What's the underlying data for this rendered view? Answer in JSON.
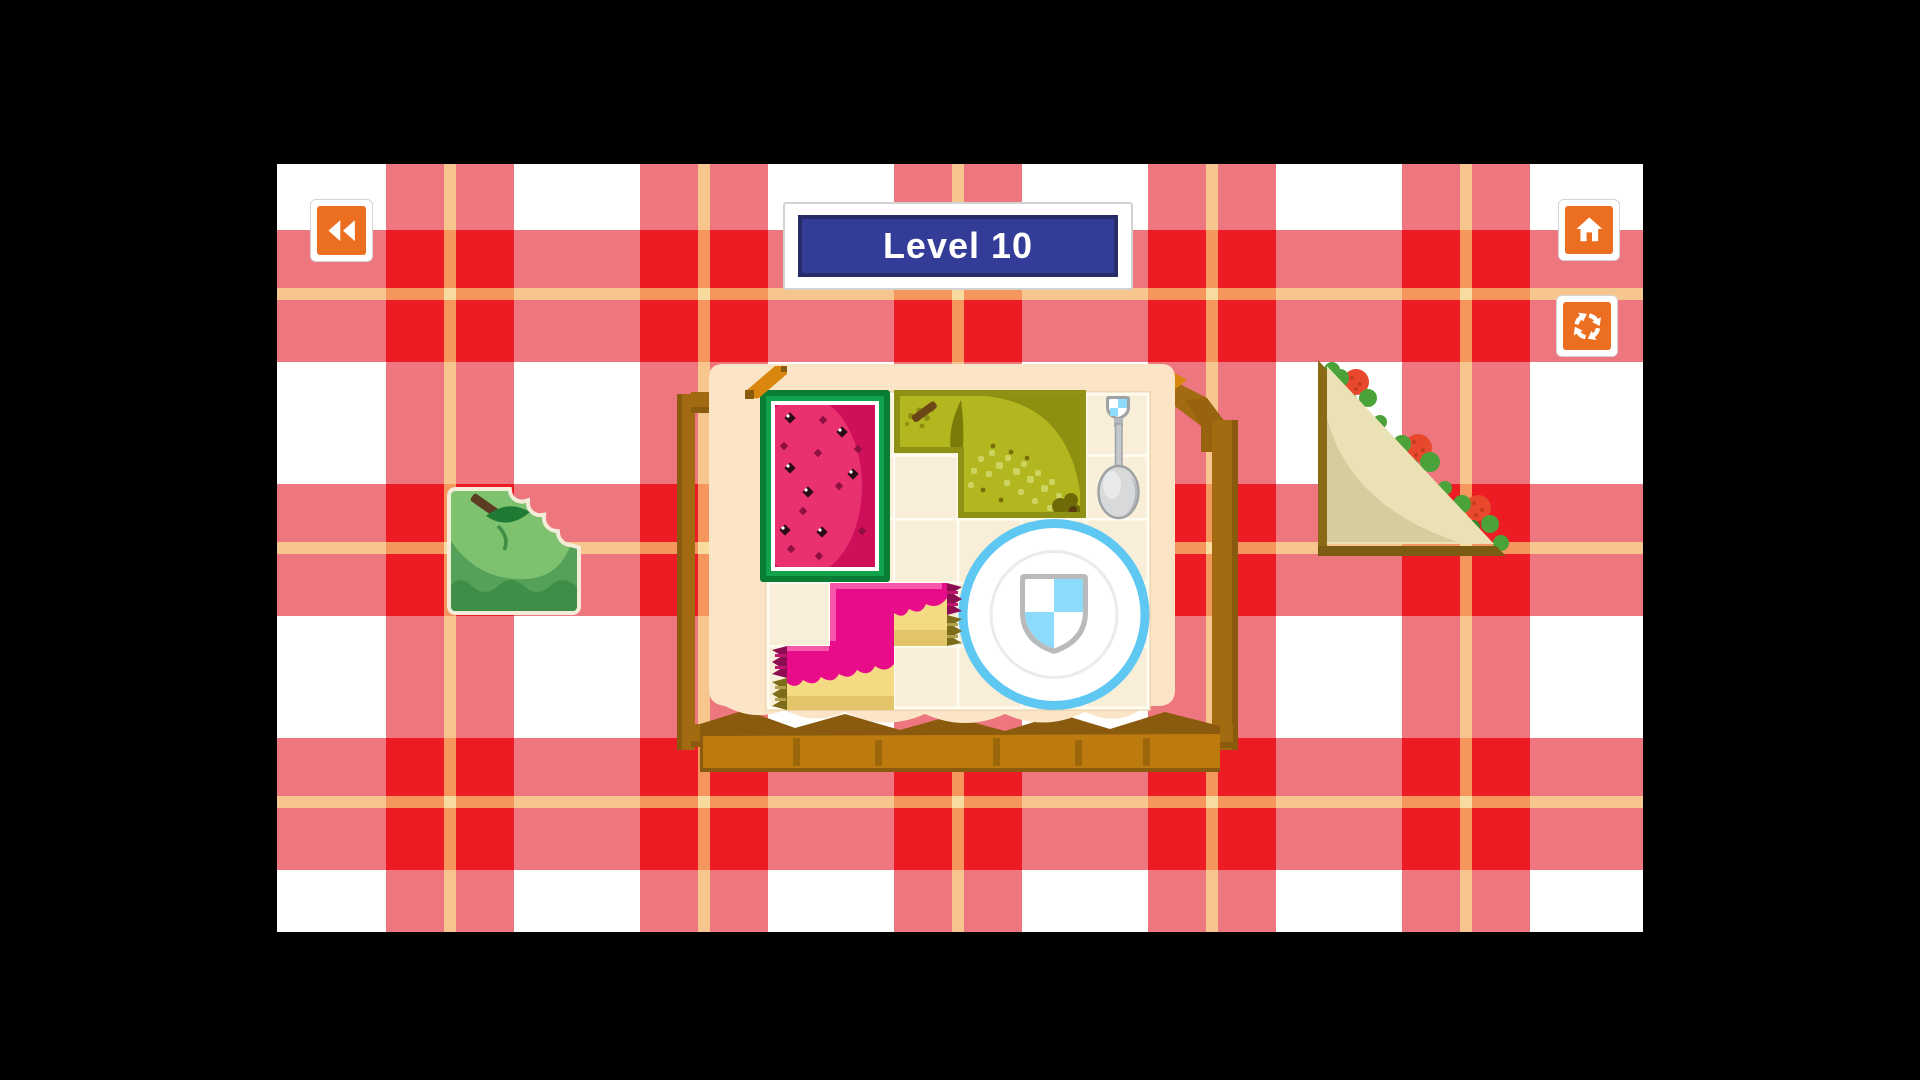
{
  "meta": {
    "description": "Picnic-themed shape puzzle game, level screen",
    "canvas": {
      "width": 1920,
      "height": 1080,
      "letterbox_color": "#000000"
    },
    "game_area": {
      "x": 277,
      "y": 164,
      "width": 1366,
      "height": 768
    }
  },
  "hud": {
    "level_banner": {
      "label": "Level 10",
      "bg": "#333d98",
      "border": "#272b66",
      "frame": "#ffffff",
      "text_color": "#ffffff"
    },
    "buttons": [
      {
        "id": "back",
        "icon": "rewind-icon",
        "fill": "#ec6e20"
      },
      {
        "id": "home",
        "icon": "home-icon",
        "fill": "#ec6e20"
      },
      {
        "id": "restart",
        "icon": "restart-icon",
        "fill": "#ec6e20"
      }
    ]
  },
  "tablecloth": {
    "colors": {
      "white": "#ffffff",
      "pink": "#ee767e",
      "red": "#ed1c24",
      "tan": "#f6c68e",
      "tan_on_pink": "#f4965e",
      "tan_cross": "#f8db9e"
    },
    "v_bands": [
      109,
      363,
      617,
      871,
      1125
    ],
    "band_width": 128,
    "h_bands": [
      66,
      320,
      574
    ],
    "band_height": 132,
    "v_stripes": [
      167,
      421,
      675,
      929,
      1183
    ],
    "h_stripes": [
      124,
      378,
      632
    ],
    "stripe_size": 12
  },
  "board": {
    "container": "wooden picnic basket with cream tray",
    "grid": {
      "cols": 6,
      "rows": 5
    },
    "fixtures": [
      {
        "id": "plate-with-shield",
        "cells": "cols 3-5, rows 2-4",
        "rim_color": "#5ec7f2",
        "shield_blue": "#8cdbfc"
      },
      {
        "id": "spoon",
        "cells": "col 5, rows 0-1"
      }
    ],
    "placed_pieces": [
      {
        "id": "watermelon-slice",
        "cells": "cols 0-1, rows 0-2",
        "colors": [
          "#0a7d35",
          "#12a24b",
          "#d00f5a",
          "#ea3170"
        ]
      },
      {
        "id": "pear-slice",
        "cells": "L-shape cols 2-4 row 0 + cols 3-4 row 1",
        "colors": [
          "#b2b71f",
          "#8f9114"
        ]
      },
      {
        "id": "jam-cake",
        "cells": "S-shape (1,3)(2,3)(0,4)(1,4)",
        "colors": [
          "#e80c8a",
          "#f4db83"
        ]
      }
    ],
    "empty_cells": [
      [
        2,
        1
      ],
      [
        2,
        2
      ],
      [
        0,
        3
      ],
      [
        2,
        4
      ]
    ]
  },
  "loose_pieces": [
    {
      "id": "apple-bitten",
      "position": "left of basket",
      "colors": [
        "#7ec26f",
        "#56a159",
        "#3f8e47"
      ]
    },
    {
      "id": "sandwich-triangle",
      "position": "right of basket",
      "colors": [
        "#eae2b4",
        "#4aa238",
        "#e8492c"
      ]
    }
  ]
}
